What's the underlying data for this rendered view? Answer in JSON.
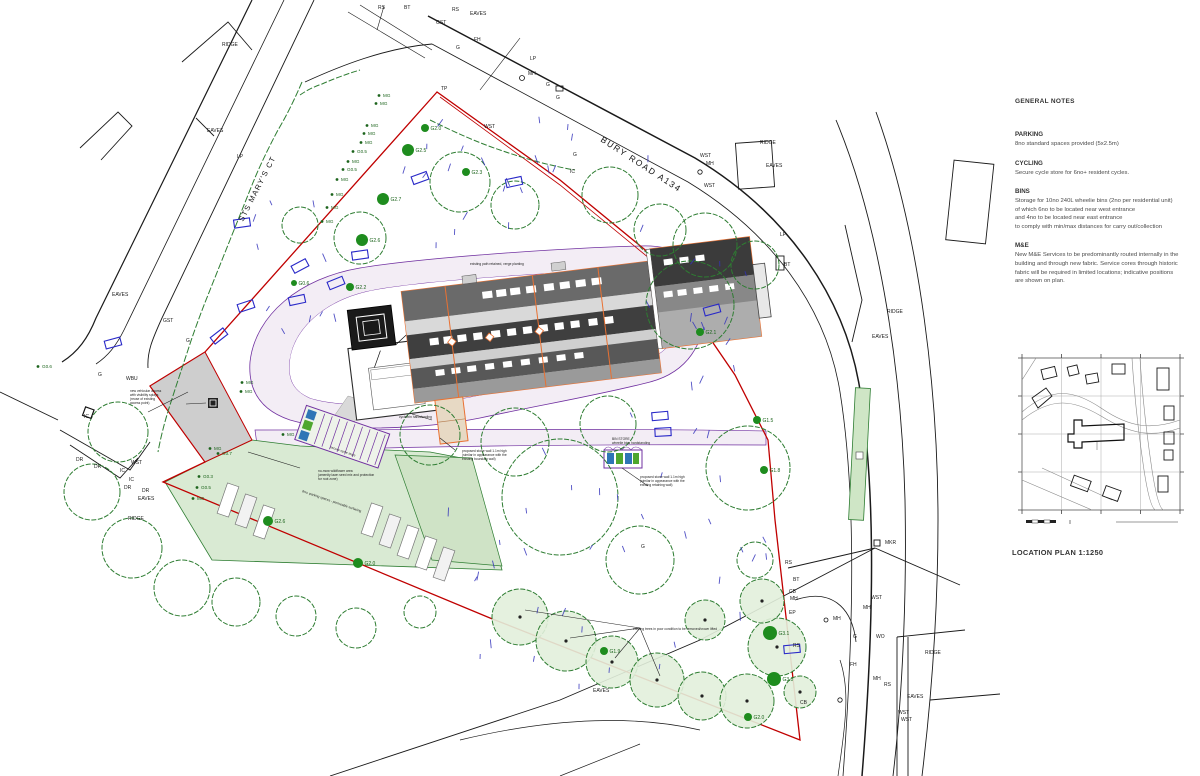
{
  "notes": {
    "heading": "GENERAL NOTES",
    "sections": [
      {
        "heading": "PARKING",
        "lines": [
          "8no standard spaces provided (5x2.5m)"
        ]
      },
      {
        "heading": "CYCLING",
        "lines": [
          "Secure cycle store for 6no+ resident cycles."
        ]
      },
      {
        "heading": "BINS",
        "lines": [
          "Storage for 10no 240L wheelie bins (2no per residential unit)",
          "of which 6no to be located near west entrance",
          "and 4no to be located near east entrance",
          "to comply with min/max distances for carry out/collection"
        ]
      },
      {
        "heading": "M&E",
        "lines": [
          "New M&E Services to be predominantly routed internally in the",
          "building and through new fabric. Service cores through historic",
          "fabric will be required in limited locations; indicative positions",
          "are shown on plan."
        ]
      }
    ]
  },
  "location_plan": {
    "label": "LOCATION PLAN 1:1250"
  },
  "roads": [
    {
      "label": "BURY ROAD A134",
      "x": 600,
      "y": 141,
      "rotate": 33,
      "size": 8.5,
      "spacing": 1.6
    },
    {
      "label": "STS MARY'S CT",
      "x": 243,
      "y": 222,
      "rotate": -63,
      "size": 7.5,
      "spacing": 1.2
    }
  ],
  "survey_labels": [
    {
      "t": "RIDGE",
      "x": 222,
      "y": 46
    },
    {
      "t": "EAVES",
      "x": 207,
      "y": 132
    },
    {
      "t": "LP",
      "x": 237,
      "y": 158
    },
    {
      "t": "RS",
      "x": 378,
      "y": 9
    },
    {
      "t": "BT",
      "x": 404,
      "y": 9
    },
    {
      "t": "RS",
      "x": 452,
      "y": 11
    },
    {
      "t": "EAVES",
      "x": 470,
      "y": 15
    },
    {
      "t": "GST",
      "x": 436,
      "y": 24
    },
    {
      "t": "FH",
      "x": 474,
      "y": 41
    },
    {
      "t": "G",
      "x": 456,
      "y": 49
    },
    {
      "t": "LP",
      "x": 530,
      "y": 60
    },
    {
      "t": "MH",
      "x": 528,
      "y": 75
    },
    {
      "t": "G",
      "x": 546,
      "y": 86
    },
    {
      "t": "G",
      "x": 556,
      "y": 99
    },
    {
      "t": "WST",
      "x": 484,
      "y": 128
    },
    {
      "t": "G",
      "x": 573,
      "y": 156
    },
    {
      "t": "IC",
      "x": 570,
      "y": 173
    },
    {
      "t": "TP",
      "x": 441,
      "y": 90
    },
    {
      "t": "WST",
      "x": 700,
      "y": 157
    },
    {
      "t": "MH",
      "x": 706,
      "y": 165
    },
    {
      "t": "WST",
      "x": 704,
      "y": 187
    },
    {
      "t": "RIDGE",
      "x": 760,
      "y": 144
    },
    {
      "t": "EAVES",
      "x": 766,
      "y": 167
    },
    {
      "t": "EAVES",
      "x": 112,
      "y": 296
    },
    {
      "t": "GST",
      "x": 163,
      "y": 322
    },
    {
      "t": "G",
      "x": 186,
      "y": 342
    },
    {
      "t": "WBU",
      "x": 126,
      "y": 380
    },
    {
      "t": "G",
      "x": 98,
      "y": 376
    },
    {
      "t": "IC",
      "x": 84,
      "y": 418
    },
    {
      "t": "DR",
      "x": 76,
      "y": 461
    },
    {
      "t": "DR",
      "x": 94,
      "y": 468
    },
    {
      "t": "WST",
      "x": 131,
      "y": 464
    },
    {
      "t": "IC",
      "x": 120,
      "y": 472
    },
    {
      "t": "IC",
      "x": 129,
      "y": 481
    },
    {
      "t": "DR",
      "x": 124,
      "y": 489
    },
    {
      "t": "DR",
      "x": 142,
      "y": 492
    },
    {
      "t": "EAVES",
      "x": 138,
      "y": 500
    },
    {
      "t": "RIDGE",
      "x": 128,
      "y": 520
    },
    {
      "t": "LP",
      "x": 780,
      "y": 236
    },
    {
      "t": "BT",
      "x": 784,
      "y": 266
    },
    {
      "t": "RIDGE",
      "x": 887,
      "y": 313
    },
    {
      "t": "EAVES",
      "x": 872,
      "y": 338
    },
    {
      "t": "MKR",
      "x": 885,
      "y": 544
    },
    {
      "t": "RS",
      "x": 785,
      "y": 564
    },
    {
      "t": "BT",
      "x": 793,
      "y": 581
    },
    {
      "t": "CB",
      "x": 789,
      "y": 593
    },
    {
      "t": "EP",
      "x": 789,
      "y": 614
    },
    {
      "t": "RS",
      "x": 793,
      "y": 647
    },
    {
      "t": "MH",
      "x": 833,
      "y": 620
    },
    {
      "t": "MH",
      "x": 863,
      "y": 609
    },
    {
      "t": "WST",
      "x": 871,
      "y": 599
    },
    {
      "t": "G",
      "x": 853,
      "y": 638
    },
    {
      "t": "WO",
      "x": 876,
      "y": 638
    },
    {
      "t": "FH",
      "x": 850,
      "y": 666
    },
    {
      "t": "MH",
      "x": 873,
      "y": 680
    },
    {
      "t": "RS",
      "x": 884,
      "y": 686
    },
    {
      "t": "CB",
      "x": 800,
      "y": 704
    },
    {
      "t": "RIDGE",
      "x": 925,
      "y": 654
    },
    {
      "t": "EAVES",
      "x": 907,
      "y": 698
    },
    {
      "t": "WST",
      "x": 898,
      "y": 714
    },
    {
      "t": "WST",
      "x": 901,
      "y": 721
    },
    {
      "t": "EAVES",
      "x": 593,
      "y": 692
    },
    {
      "t": "G",
      "x": 641,
      "y": 548
    },
    {
      "t": "MH",
      "x": 790,
      "y": 600
    }
  ],
  "mg_labels": [
    {
      "t": "MG",
      "x": 383,
      "y": 97
    },
    {
      "t": "MG",
      "x": 380,
      "y": 105
    },
    {
      "t": "MG",
      "x": 371,
      "y": 127
    },
    {
      "t": "MG",
      "x": 368,
      "y": 135
    },
    {
      "t": "MG",
      "x": 365,
      "y": 144
    },
    {
      "t": "G0.5",
      "x": 357,
      "y": 153
    },
    {
      "t": "MG",
      "x": 352,
      "y": 163
    },
    {
      "t": "G0.5",
      "x": 347,
      "y": 171
    },
    {
      "t": "MG",
      "x": 341,
      "y": 181
    },
    {
      "t": "MG",
      "x": 336,
      "y": 196
    },
    {
      "t": "MG",
      "x": 331,
      "y": 209
    },
    {
      "t": "MG",
      "x": 326,
      "y": 223
    },
    {
      "t": "MG",
      "x": 246,
      "y": 384
    },
    {
      "t": "MG",
      "x": 245,
      "y": 393
    },
    {
      "t": "MG",
      "x": 214,
      "y": 450
    },
    {
      "t": "G0.7",
      "x": 222,
      "y": 455
    },
    {
      "t": "G0.3",
      "x": 203,
      "y": 478
    },
    {
      "t": "G0.5",
      "x": 201,
      "y": 489
    },
    {
      "t": "MG",
      "x": 197,
      "y": 500
    },
    {
      "t": "MG",
      "x": 287,
      "y": 436
    },
    {
      "t": "G0.6",
      "x": 42,
      "y": 368
    }
  ],
  "tree_markers": [
    {
      "t": "G2.0",
      "x": 425,
      "y": 128,
      "r": 4
    },
    {
      "t": "G2.5",
      "x": 408,
      "y": 150,
      "r": 6
    },
    {
      "t": "G2.3",
      "x": 466,
      "y": 172,
      "r": 4
    },
    {
      "t": "G2.7",
      "x": 383,
      "y": 199,
      "r": 6
    },
    {
      "t": "G2.6",
      "x": 362,
      "y": 240,
      "r": 6
    },
    {
      "t": "G0.6",
      "x": 294,
      "y": 283,
      "r": 3
    },
    {
      "t": "G2.2",
      "x": 350,
      "y": 287,
      "r": 4
    },
    {
      "t": "G2.6",
      "x": 268,
      "y": 521,
      "r": 5
    },
    {
      "t": "G2.0",
      "x": 358,
      "y": 563,
      "r": 5
    },
    {
      "t": "G1.9",
      "x": 604,
      "y": 651,
      "r": 4
    },
    {
      "t": "G3.1",
      "x": 770,
      "y": 633,
      "r": 7
    },
    {
      "t": "G3.0",
      "x": 774,
      "y": 679,
      "r": 7
    },
    {
      "t": "G2.0",
      "x": 748,
      "y": 717,
      "r": 4
    },
    {
      "t": "G1.5",
      "x": 757,
      "y": 420,
      "r": 4
    },
    {
      "t": "G1.8",
      "x": 764,
      "y": 470,
      "r": 4
    },
    {
      "t": "G2.1",
      "x": 700,
      "y": 332,
      "r": 4
    }
  ],
  "annotations": [
    {
      "x": 130,
      "y": 392,
      "lines": [
        "new vehicular access",
        "with visibility splays",
        "(reuse of existing",
        "access point)"
      ]
    },
    {
      "x": 399,
      "y": 418,
      "lines": [
        "cycle/bin hardstanding"
      ]
    },
    {
      "x": 462,
      "y": 452,
      "lines": [
        "proposed stone wall 1.1m high",
        "(similar in appearance with the",
        "existing boundary wall)"
      ]
    },
    {
      "x": 640,
      "y": 478,
      "lines": [
        "proposed stone wall 1.1m high",
        "(similar in appearance with the",
        "existing retaining wall)"
      ]
    },
    {
      "x": 318,
      "y": 472,
      "lines": [
        "no-mow wildflower area",
        "(amenity lawn seed mix and protection",
        "for root zone)"
      ]
    },
    {
      "x": 612,
      "y": 440,
      "lines": [
        "BIN STORE",
        "wheelie bins hardstanding"
      ]
    },
    {
      "x": 470,
      "y": 265,
      "lines": [
        "existing path retained, verge planting"
      ]
    },
    {
      "x": 633,
      "y": 630,
      "lines": [
        "existing trees in poor condition to be removed/crown lifted"
      ]
    },
    {
      "x": 302,
      "y": 492,
      "lines": [
        "8no. parking spaces - permeable surfacing"
      ],
      "rotate": 19
    },
    {
      "x": 330,
      "y": 448,
      "lines": [
        "secure cycle store"
      ],
      "rotate": 19
    }
  ],
  "colors": {
    "boundary": "#c00000",
    "road": "#1a1a1a",
    "tree_green": "#2e7d32",
    "lawn": "#d9ead3",
    "path_fill": "#f3edf5",
    "path_edge": "#7030a0",
    "roof_dark": "#4a4a4a",
    "roof_light": "#d9d9d9",
    "building_edge": "#e97132",
    "headstone_blue": "#2929c8",
    "grass_blue": "#3333bb"
  }
}
